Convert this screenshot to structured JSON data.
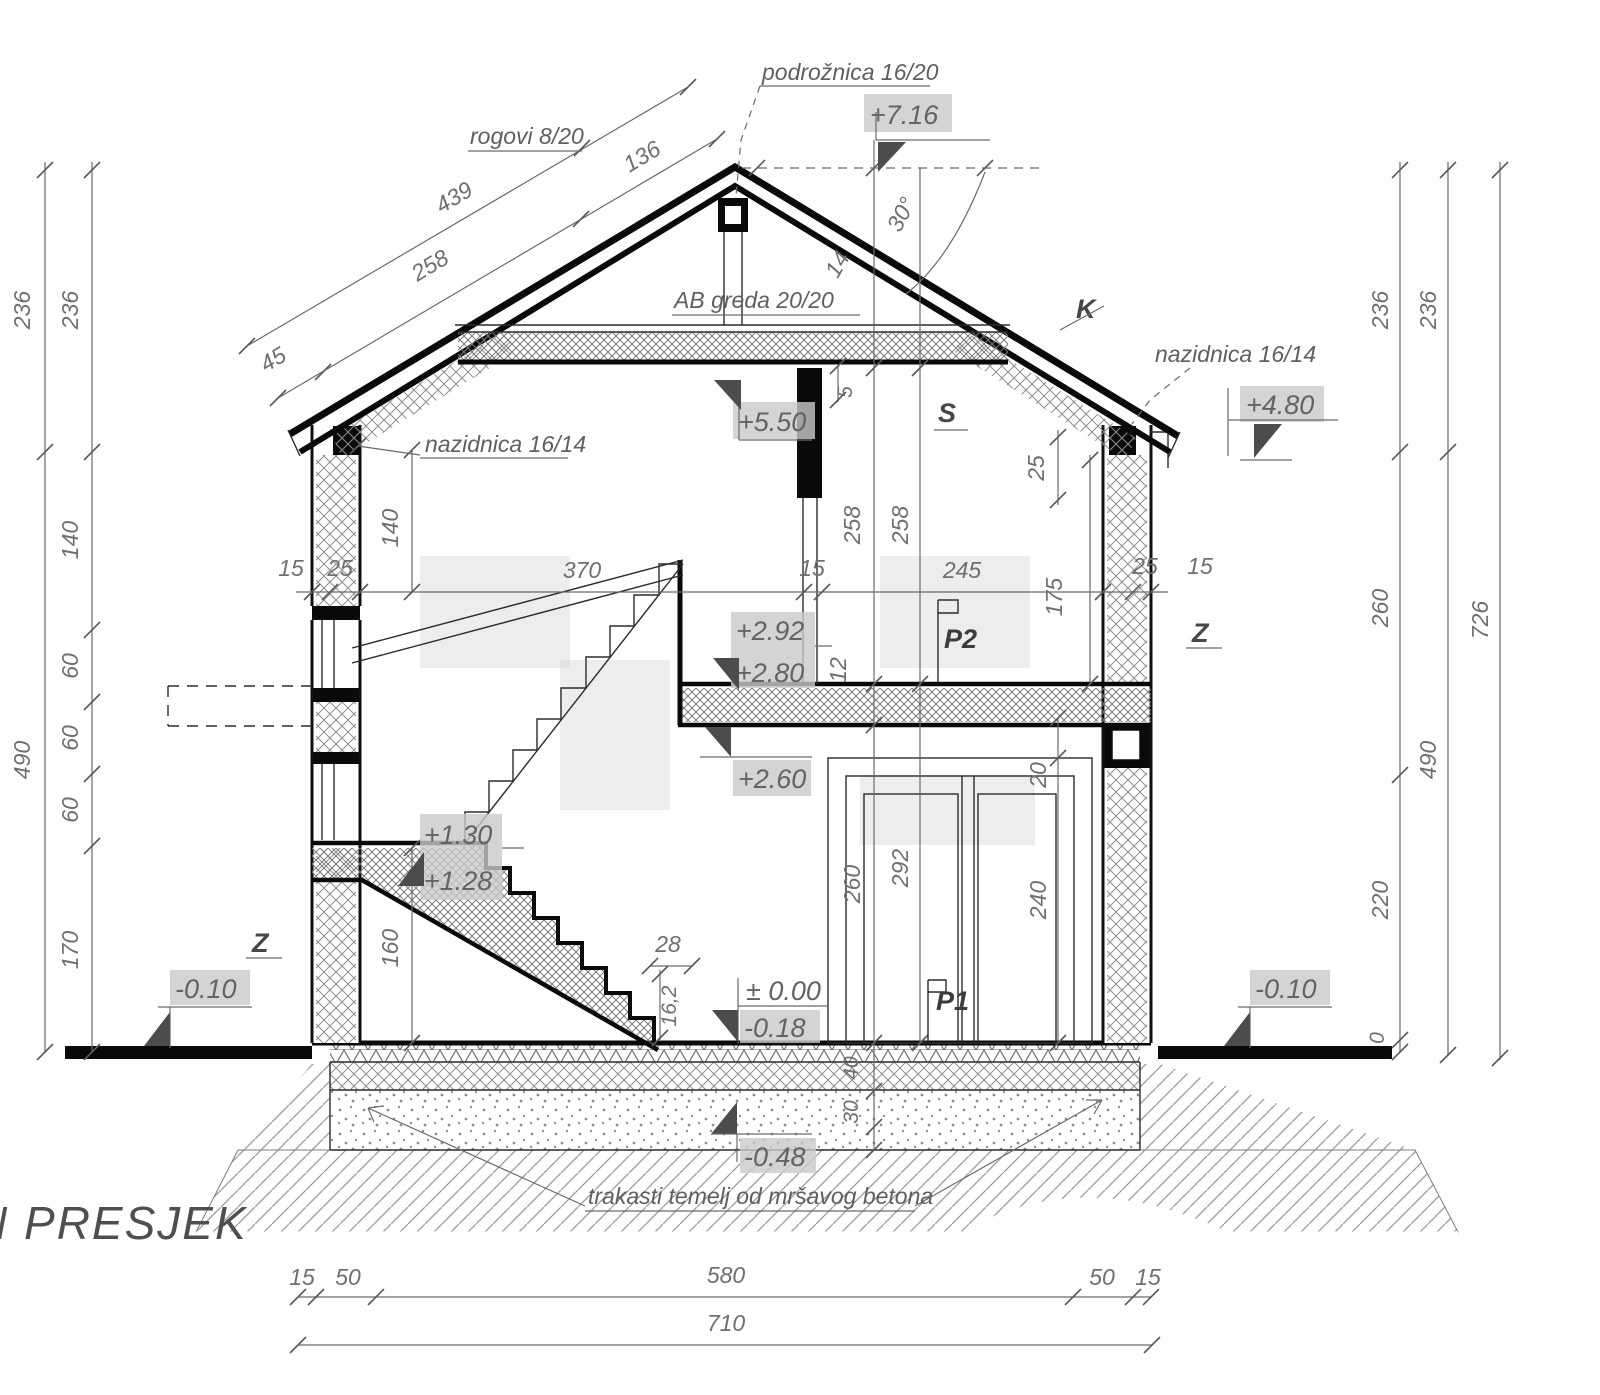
{
  "title": {
    "prefix": "N",
    "text": "PRESJEK"
  },
  "t": {
    "d236": "236",
    "d490": "490",
    "d140": "140",
    "d60": "60",
    "d170": "170",
    "d260": "260",
    "d220": "220",
    "d726": "726",
    "d0": "0",
    "d258": "258",
    "d292": "292",
    "d240": "240",
    "d20": "20",
    "d25": "25",
    "d15": "15",
    "d50": "50",
    "d45": "45",
    "d439": "439",
    "d136": "136",
    "d370": "370",
    "d245": "245",
    "d175": "175",
    "d12": "12",
    "d5": "5",
    "d14": "14",
    "d28": "28",
    "d160": "160",
    "d162": "16,2",
    "d40": "40",
    "d30": "30",
    "d580": "580",
    "d710": "710",
    "angle": "30°"
  },
  "m": {
    "p716": "+7.16",
    "p550": "+5.50",
    "p480": "+4.80",
    "p292": "+2.92",
    "p280": "+2.80",
    "p260": "+2.60",
    "p130": "+1.30",
    "p128": "+1.28",
    "zero": "± 0.00",
    "n018": "-0.18",
    "n010": "-0.10",
    "n048": "-0.48"
  },
  "lbl": {
    "podroznica": "podrožnica 16/20",
    "rogovi": "rogovi 8/20",
    "abgreda": "AB greda 20/20",
    "nazidnica": "nazidnica 16/14",
    "temelj": "trakasti temelj od mršavog betona",
    "k": "K",
    "s": "S",
    "z": "Z",
    "p1": "P1",
    "p2": "P2"
  }
}
